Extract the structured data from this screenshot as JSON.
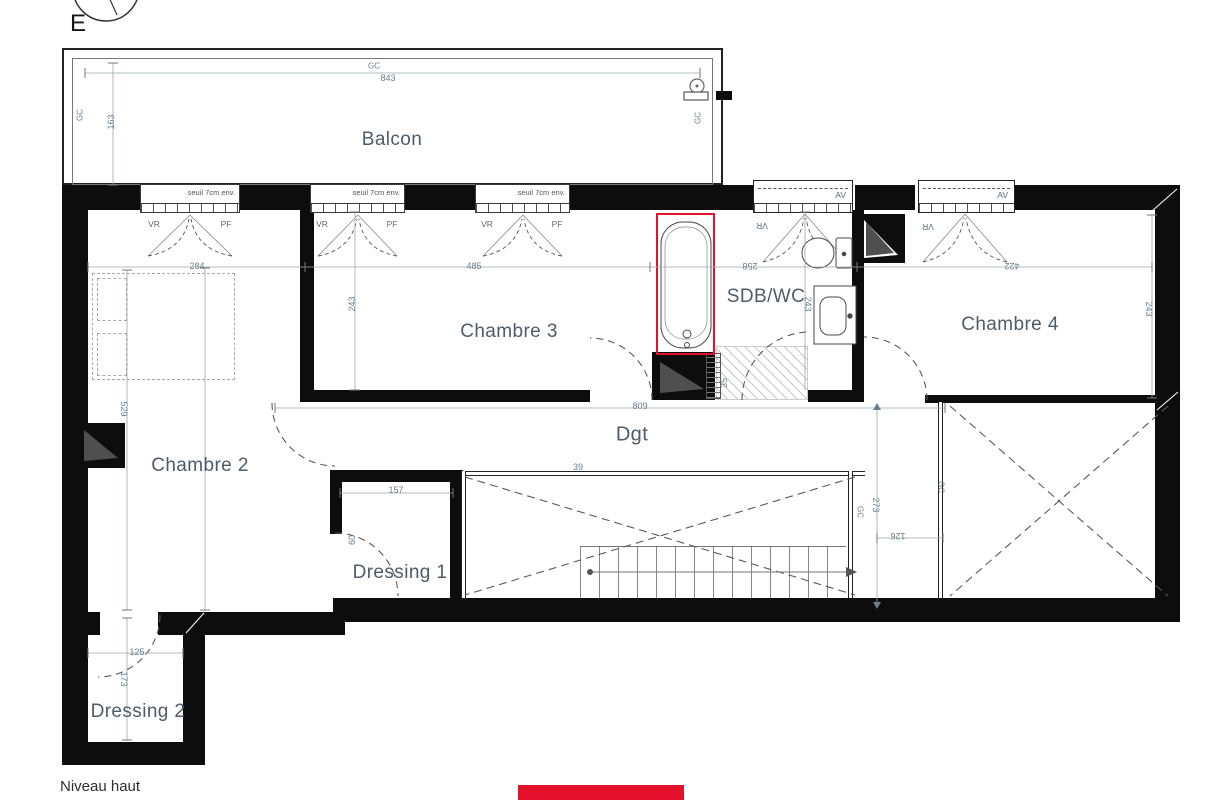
{
  "title": {
    "orientation": "E",
    "level_label": "Niveau haut"
  },
  "rooms": {
    "balcon": "Balcon",
    "chambre2": "Chambre 2",
    "chambre3": "Chambre 3",
    "chambre4": "Chambre 4",
    "sdb": "SDB/WC",
    "dgt": "Dgt",
    "dressing1": "Dressing 1",
    "dressing2": "Dressing 2"
  },
  "glazing": {
    "seuil": "seuil 7cm env.",
    "vr": "VR",
    "pf": "PF",
    "av": "AV",
    "gc": "GC"
  },
  "dims": {
    "balcony_w": "843",
    "balcony_d": "163",
    "ch2_w": "284",
    "ch2_h": "529",
    "ch3_w": "485",
    "ch3_h": "243",
    "sdb_w": "258",
    "sdb_h": "243",
    "ch4_w": "422",
    "ch4_h": "243",
    "dgt_w": "809",
    "void_w": "39",
    "dr1_w": "157",
    "dr1_door": "60",
    "corridor_h": "273",
    "corridor_w": "126",
    "dr2_w": "125",
    "dr2_h": "173",
    "shower_strip": "35"
  },
  "colors": {
    "accent_red": "#e3112c",
    "wall": "#0d0d0d",
    "room_label": "#4d5c6a",
    "dim_label": "#67808f"
  }
}
